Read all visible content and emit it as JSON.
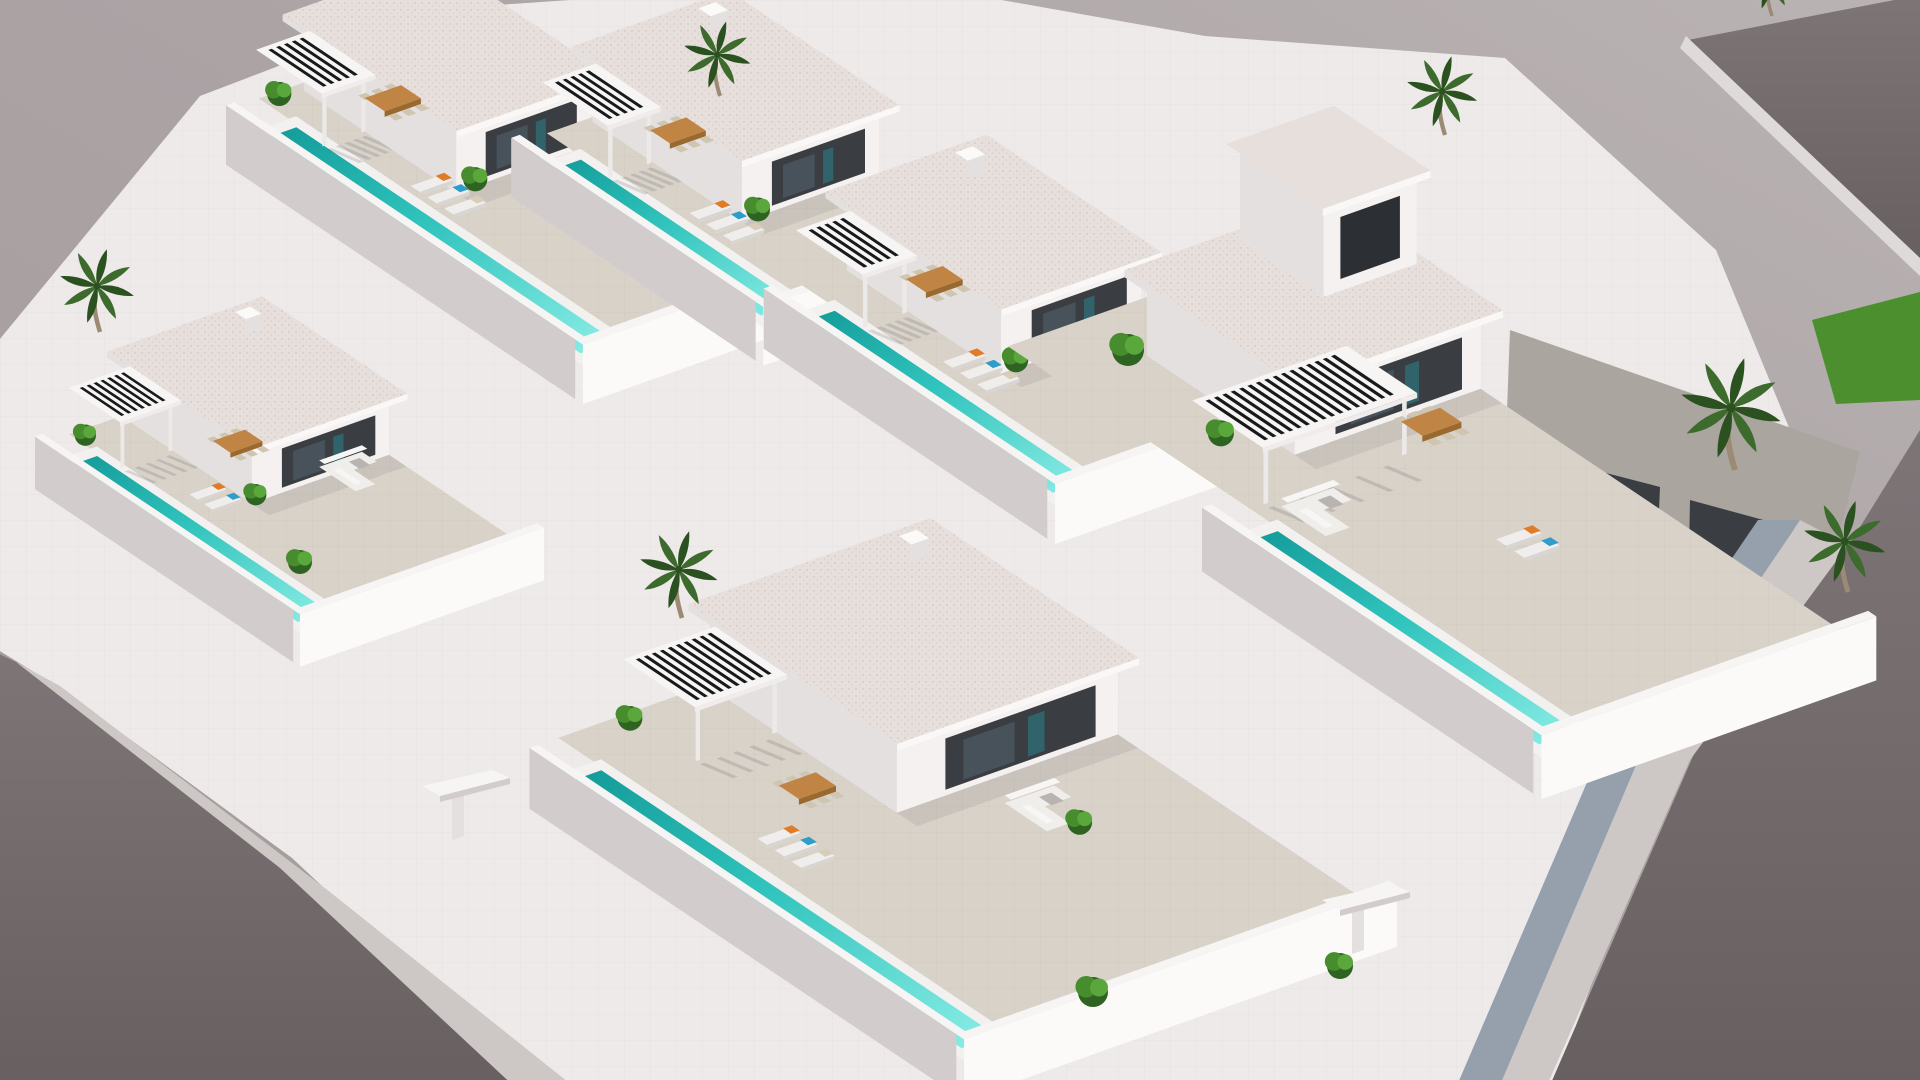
{
  "scene": {
    "title": "Aerial 3D render of a modern white villa development with private turquoise lap pools, pergolas, roof terraces, palm trees and surrounding gray streets",
    "type": "architectural-render",
    "camera": "high-angle isometric aerial",
    "palette": {
      "bg1": "#a89fa0",
      "bg2": "#bab3b3",
      "street": "#746d6e",
      "street2": "#665f60",
      "sidewalk": "#cdc7c6",
      "sidewalkLit": "#dedad9",
      "shadowBlue": "#96a0ad",
      "base": "#edeae9",
      "wallTop": "#f7f5f4",
      "wallSun": "#fbfaf9",
      "wallMid": "#e4e0df",
      "wallShade": "#d2cdcc",
      "wallDark": "#c2bdbc",
      "roof": "#e7dfdc",
      "roofEdge": "#faf8f7",
      "terrace": "#d8d2c9",
      "court": "#aba59f",
      "poolRim": "#f3f1f0",
      "poolDeep": "#149e9b",
      "poolMid": "#31c4bd",
      "poolPale": "#8ceee6",
      "facade": "#3a3d41",
      "facadeDark": "#2c2f33",
      "glass": "#4a545e",
      "glassTeal": "#2e6e74",
      "slat": "#17191b",
      "wood": "#c08445",
      "woodDark": "#9a6930",
      "chair": "#cfc5b0",
      "sofa": "#f0eeeb",
      "cushion": "#f8f6f4",
      "gray": "#b9b4b1",
      "orange": "#e07b28",
      "blue": "#2e9dc9",
      "beige": "#d8cdb8",
      "leaf1": "#2f6322",
      "leaf2": "#478d2e",
      "leaf3": "#5aa83c",
      "palmLeaf": "#3d6b2d",
      "palmDark": "#2c5120",
      "trunk": "#9b8b74",
      "grass": "#4c8f2f",
      "doorDark": "#3a3d41"
    },
    "ground": [
      {
        "name": "complex-base",
        "fill": "base",
        "pts": [
          [
            200,
            96
          ],
          [
            425,
            10
          ],
          [
            715,
            -10
          ],
          [
            945,
            -10
          ],
          [
            1205,
            36
          ],
          [
            1505,
            58
          ],
          [
            1716,
            250
          ],
          [
            1790,
            430
          ],
          [
            1695,
            705
          ],
          [
            1552,
            1090
          ],
          [
            540,
            1090
          ],
          [
            292,
            858
          ],
          [
            60,
            688
          ],
          [
            -5,
            648
          ],
          [
            -5,
            345
          ]
        ]
      },
      {
        "name": "right-courtyard-floor",
        "fill": "court",
        "pts": [
          [
            1510,
            330
          ],
          [
            1860,
            452
          ],
          [
            1790,
            730
          ],
          [
            1500,
            600
          ]
        ]
      },
      {
        "name": "courtyard-door-1",
        "fill": "doorDark",
        "pts": [
          [
            1575,
            465
          ],
          [
            1660,
            487
          ],
          [
            1656,
            580
          ],
          [
            1572,
            555
          ]
        ]
      },
      {
        "name": "courtyard-door-2",
        "fill": "doorDark",
        "pts": [
          [
            1690,
            500
          ],
          [
            1800,
            530
          ],
          [
            1795,
            640
          ],
          [
            1688,
            605
          ]
        ]
      },
      {
        "name": "grass-strip",
        "fill": "grass",
        "pts": [
          [
            1812,
            320
          ],
          [
            1920,
            292
          ],
          [
            1920,
            400
          ],
          [
            1836,
            404
          ]
        ]
      },
      {
        "name": "street-left",
        "fill": "street2",
        "pts": [
          [
            -5,
            652
          ],
          [
            16,
            662
          ],
          [
            282,
            866
          ],
          [
            522,
            1090
          ],
          [
            -5,
            1090
          ]
        ]
      },
      {
        "name": "sidewalk-left",
        "fill": "sidewalk",
        "pts": [
          [
            16,
            662
          ],
          [
            60,
            686
          ],
          [
            330,
            892
          ],
          [
            578,
            1090
          ],
          [
            518,
            1090
          ],
          [
            280,
            868
          ]
        ]
      },
      {
        "name": "street-top-right",
        "fill": "street",
        "pts": [
          [
            1688,
            40
          ],
          [
            1920,
            -5
          ],
          [
            1920,
            262
          ]
        ]
      },
      {
        "name": "street-bottom-right",
        "fill": "street",
        "pts": [
          [
            1920,
            430
          ],
          [
            1920,
            1090
          ],
          [
            1548,
            1090
          ],
          [
            1700,
            740
          ],
          [
            1852,
            540
          ]
        ]
      },
      {
        "name": "sidewalk-right",
        "fill": "sidewalk",
        "pts": [
          [
            1800,
            520
          ],
          [
            1848,
            545
          ],
          [
            1690,
            760
          ],
          [
            1545,
            1090
          ],
          [
            1498,
            1090
          ],
          [
            1640,
            756
          ]
        ]
      },
      {
        "name": "sidewalk-right-shadow",
        "fill": "shadowBlue",
        "pts": [
          [
            1758,
            520
          ],
          [
            1800,
            520
          ],
          [
            1640,
            756
          ],
          [
            1498,
            1090
          ],
          [
            1455,
            1090
          ],
          [
            1600,
            752
          ]
        ]
      },
      {
        "name": "curb-top-right",
        "fill": "sidewalkLit",
        "pts": [
          [
            1686,
            36
          ],
          [
            1920,
            258
          ],
          [
            1920,
            276
          ],
          [
            1680,
            48
          ]
        ]
      }
    ],
    "villas": [
      {
        "id": "villa-1",
        "anchor": [
          252,
          168
        ],
        "s": 0.93,
        "plotW": 250,
        "poolD": 430,
        "terrB": [
          -50,
          434
        ],
        "houseA": [
          95,
          250
        ],
        "houseB": [
          -40,
          160
        ],
        "houseH": 100,
        "pergA": [
          40,
          102
        ],
        "pergB": [
          -40,
          46
        ],
        "dining": [
          118,
          14
        ],
        "loungers": [
          60,
          140,
          3
        ],
        "sofa": null,
        "plants": [
          [
            110,
            168
          ],
          [
            58,
            -30
          ]
        ]
      },
      {
        "id": "villa-2",
        "anchor": [
          537,
          200
        ],
        "s": 0.92,
        "plotW": 260,
        "poolD": 296,
        "terrB": [
          -46,
          300
        ],
        "houseA": [
          100,
          260
        ],
        "houseB": [
          -40,
          158
        ],
        "houseH": 100,
        "pergA": [
          42,
          104
        ],
        "pergB": [
          -40,
          46
        ],
        "dining": [
          120,
          14
        ],
        "loungers": [
          62,
          132,
          3
        ],
        "sofa": [
          196,
          196
        ],
        "plants": [
          [
            112,
            166
          ]
        ]
      },
      {
        "id": "villa-3",
        "anchor": [
          790,
          352
        ],
        "s": 0.94,
        "plotW": 262,
        "poolD": 340,
        "terrB": [
          -48,
          344
        ],
        "houseA": [
          102,
          262
        ],
        "houseB": [
          -42,
          158
        ],
        "houseH": 102,
        "pergA": [
          44,
          106
        ],
        "pergB": [
          -42,
          44
        ],
        "dining": [
          122,
          12
        ],
        "loungers": [
          64,
          126,
          3
        ],
        "sofa": [
          198,
          192
        ],
        "plants": [
          [
            114,
            164
          ]
        ]
      },
      {
        "id": "villa-4",
        "anchor": [
          58,
          492
        ],
        "s": 0.82,
        "plotW": 300,
        "poolD": 356,
        "terrB": [
          -42,
          360
        ],
        "houseA": [
          120,
          300
        ],
        "houseB": [
          -36,
          152
        ],
        "houseH": 100,
        "pergA": [
          46,
          126
        ],
        "pergB": [
          -36,
          40
        ],
        "dining": [
          152,
          58
        ],
        "loungers": [
          70,
          116,
          2
        ],
        "sofa": [
          212,
          148
        ],
        "plants": [
          [
            50,
            -16
          ],
          [
            120,
            158
          ]
        ]
      },
      {
        "id": "villa-6",
        "anchor": [
          1230,
          575
        ],
        "s": 1.0,
        "plotW": 340,
        "poolD": 376,
        "terrB": [
          -330,
          380
        ],
        "houseA": [
          140,
          340
        ],
        "houseB": [
          -260,
          -80
        ],
        "houseH": 104,
        "tower": {
          "a": [
            240,
            340
          ],
          "b": [
            -260,
            -158
          ],
          "h": 88
        },
        "pergA": [
          60,
          226
        ],
        "pergB": [
          -114,
          -28
        ],
        "dining": [
          235,
          -58
        ],
        "loungers": [
          185,
          115,
          2
        ],
        "sofa": [
          64,
          -10
        ],
        "plants": [
          [
            96,
            -120
          ]
        ]
      },
      {
        "id": "villa-5",
        "anchor": [
          556,
          812
        ],
        "s": 0.95,
        "plotW": 470,
        "poolD": 520,
        "terrB": [
          -56,
          524
        ],
        "houseA": [
          220,
          470
        ],
        "houseB": [
          -52,
          188
        ],
        "houseH": 106,
        "pergA": [
          122,
          226
        ],
        "pergB": [
          -52,
          40
        ],
        "dining": [
          148,
          118
        ],
        "loungers": [
          80,
          168,
          3
        ],
        "sofa": [
          298,
          238
        ],
        "plants": [
          [
            112,
            -32
          ],
          [
            330,
            298
          ]
        ]
      }
    ],
    "palms": [
      {
        "x": 720,
        "y": 96,
        "s": 0.9
      },
      {
        "x": 1445,
        "y": 135,
        "s": 0.95
      },
      {
        "x": 100,
        "y": 332,
        "s": 1.0
      },
      {
        "x": 682,
        "y": 618,
        "s": 1.05
      },
      {
        "x": 1735,
        "y": 470,
        "s": 1.35
      },
      {
        "x": 1848,
        "y": 592,
        "s": 1.1
      },
      {
        "x": 1772,
        "y": 16,
        "s": 0.8
      }
    ],
    "bushes": [
      {
        "x": 1093,
        "y": 992,
        "r": 15
      },
      {
        "x": 1340,
        "y": 966,
        "r": 13
      },
      {
        "x": 300,
        "y": 562,
        "r": 12
      },
      {
        "x": 1128,
        "y": 350,
        "r": 16
      }
    ],
    "gates": [
      {
        "x": 452,
        "y": 792,
        "s": 1.0
      },
      {
        "x": 1352,
        "y": 906,
        "s": 1.0
      }
    ],
    "cushionColors": [
      "orange",
      "blue",
      "beige"
    ]
  }
}
